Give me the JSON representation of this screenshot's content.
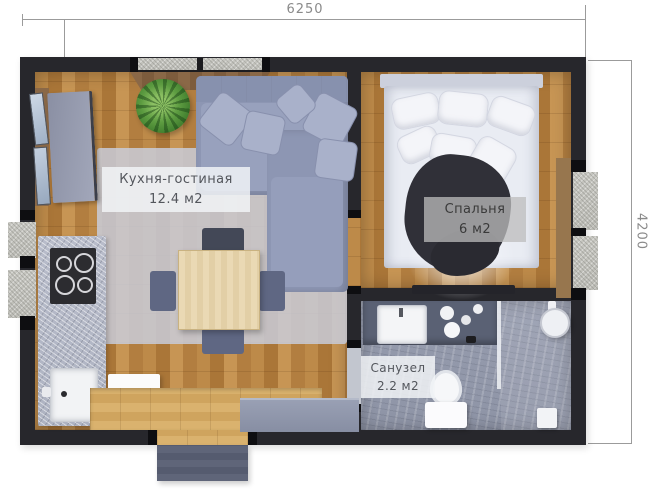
{
  "plan": {
    "title": "one-room house floor plan",
    "dimensions": {
      "width_mm": "6250",
      "height_mm": "4200"
    },
    "rooms": [
      {
        "name": "Кухня-гостиная",
        "area": "12.4 м2"
      },
      {
        "name": "Спальня",
        "area": "6 м2"
      },
      {
        "name": "Санузел",
        "area": "2.2 м2"
      }
    ],
    "furniture_visible": [
      "corner-sofa",
      "rug",
      "dining-table",
      "chairs",
      "plant",
      "tv-panel",
      "kitchen-counter",
      "cooktop",
      "kitchen-sink",
      "dishwasher",
      "wardrobe",
      "entry-platform",
      "porch",
      "double-bed",
      "blanket",
      "foot-bench",
      "bathroom-vanity",
      "bathroom-sink",
      "toilet",
      "shower",
      "shower-head"
    ],
    "colors": {
      "wall": "#27272c",
      "wood_floor": "#b5803f",
      "entry_platform": "#d2a964",
      "tile_floor": "#959bad",
      "sofa": "#8d96b3",
      "rug": "#c9cdd9",
      "bed_linen": "#edeff5",
      "blanket": "#303037",
      "counter_marble": "#b7bbc8",
      "porch": "#596078",
      "label_text": "#53565c",
      "dimension_text": "#8a8a8a"
    }
  }
}
